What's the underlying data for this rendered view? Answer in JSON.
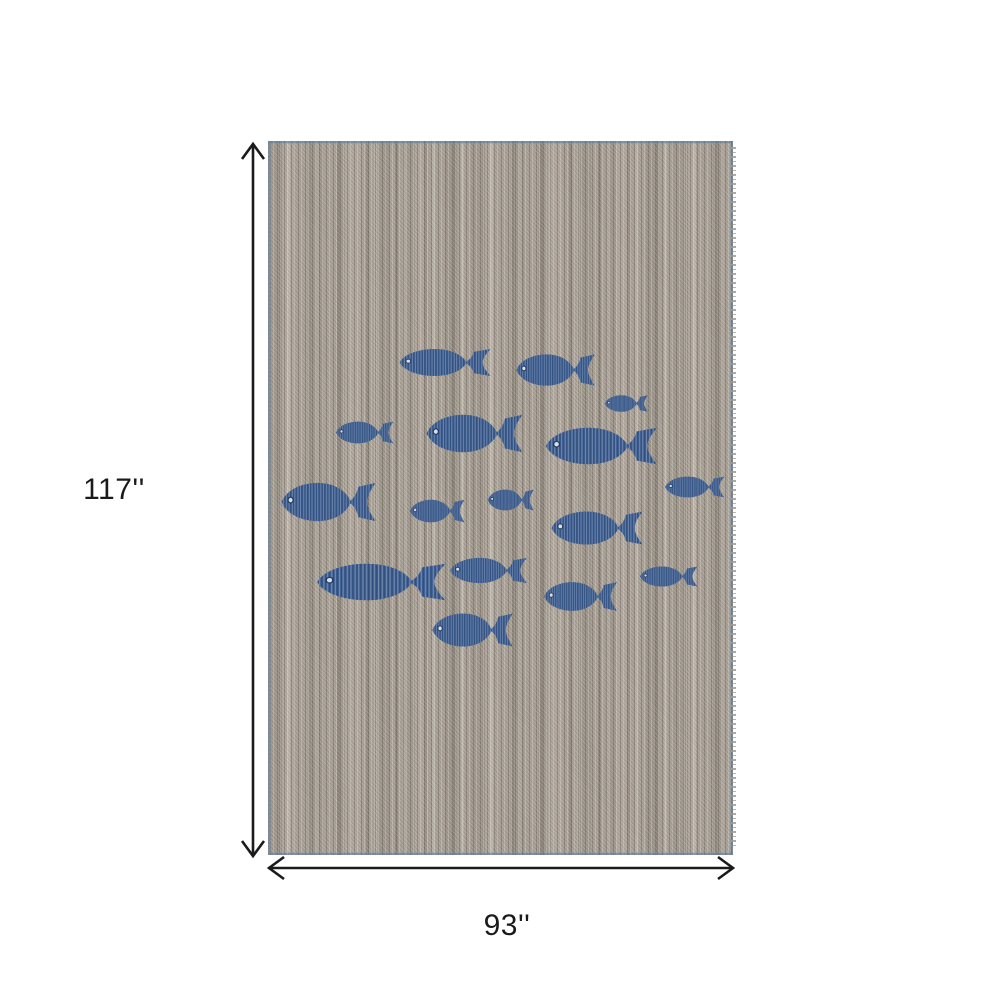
{
  "figure": {
    "type": "product-dimension-diagram",
    "subject": "gray woven area rug with school of blue fish motifs"
  },
  "dimensions": {
    "height_label": "117''",
    "width_label": "93''",
    "arrow_color": "#1b1b1b",
    "label_color": "#1a1a1a"
  },
  "rug": {
    "left": 268,
    "top": 141,
    "width": 465,
    "height": 714,
    "base_color": "#a79e93",
    "selvage_color": "#5d83a8",
    "fish_color": "#3c5d90",
    "fish_eye_color": "#d9dfe8",
    "fish": [
      {
        "x": 445,
        "y": 362,
        "w": 95,
        "h": 31
      },
      {
        "x": 556,
        "y": 370,
        "w": 82,
        "h": 36
      },
      {
        "x": 626,
        "y": 403,
        "w": 45,
        "h": 19
      },
      {
        "x": 365,
        "y": 432,
        "w": 60,
        "h": 25
      },
      {
        "x": 475,
        "y": 433,
        "w": 100,
        "h": 43
      },
      {
        "x": 602,
        "y": 446,
        "w": 116,
        "h": 42
      },
      {
        "x": 329,
        "y": 502,
        "w": 98,
        "h": 44
      },
      {
        "x": 437,
        "y": 511,
        "w": 57,
        "h": 26
      },
      {
        "x": 511,
        "y": 500,
        "w": 48,
        "h": 24
      },
      {
        "x": 597,
        "y": 528,
        "w": 95,
        "h": 38
      },
      {
        "x": 695,
        "y": 487,
        "w": 62,
        "h": 24
      },
      {
        "x": 382,
        "y": 582,
        "w": 134,
        "h": 42
      },
      {
        "x": 489,
        "y": 570,
        "w": 80,
        "h": 29
      },
      {
        "x": 581,
        "y": 596,
        "w": 76,
        "h": 33
      },
      {
        "x": 669,
        "y": 576,
        "w": 60,
        "h": 23
      },
      {
        "x": 473,
        "y": 630,
        "w": 84,
        "h": 38
      }
    ]
  }
}
